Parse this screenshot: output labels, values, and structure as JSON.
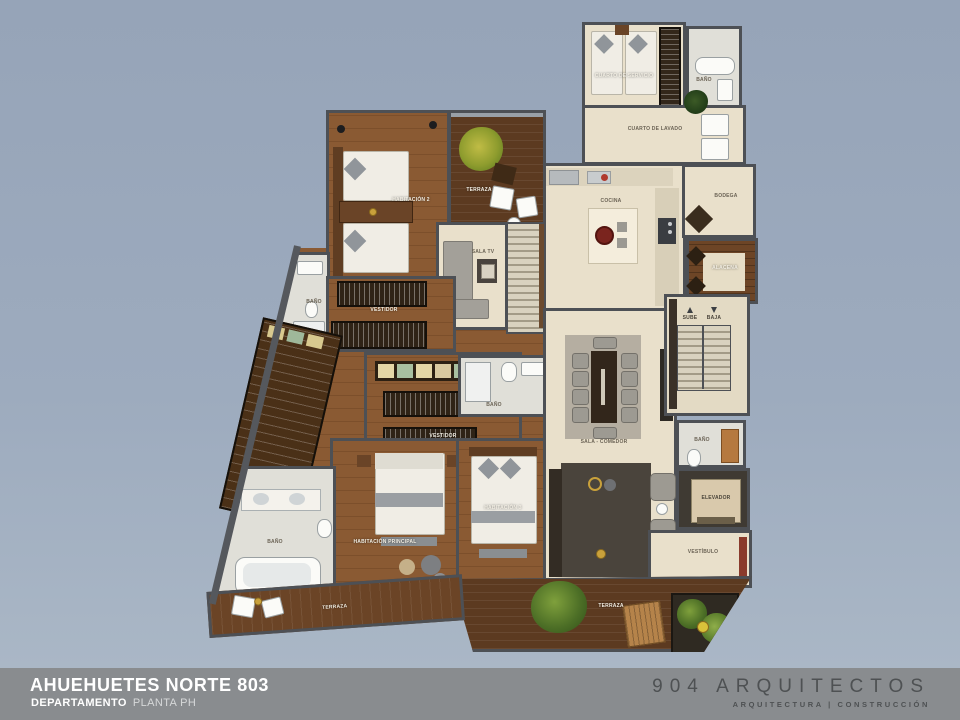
{
  "title_block": {
    "project": "AHUEHUETES NORTE 803",
    "unit_type": "DEPARTAMENTO",
    "floor": "PLANTA PH"
  },
  "brand": {
    "name": "904 ARQUITECTOS",
    "tagline": "ARQUITECTURA | CONSTRUCCIÓN"
  },
  "colors": {
    "background": "#9dabbe",
    "footer_bar": "#898c8f",
    "walls": "#4d5055",
    "wood_floor": "#8f5d35",
    "stone_floor": "#e9e0cb",
    "bath_floor": "#e0dfd8",
    "terrace_wood": "#5c3a20"
  },
  "rooms": {
    "cuarto_servicio": "CUARTO DE SERVICIO",
    "bano": "BAÑO",
    "cuarto_lavado": "CUARTO DE LAVADO",
    "bodega": "BODEGA",
    "cocina": "COCINA",
    "alacena": "ALACENA",
    "terraza": "TERRAZA",
    "habitacion_2": "HABITACIÓN 2",
    "sala_tv": "SALA TV",
    "vestidor": "VESTIDOR",
    "habitacion_principal": "HABITACIÓN PRINCIPAL",
    "habitacion_3": "HABITACIÓN 3",
    "sala_comedor": "SALA - COMEDOR",
    "sube": "SUBE",
    "baja": "BAJA",
    "elevador": "ELEVADOR",
    "vestibulo": "VESTÍBULO"
  }
}
